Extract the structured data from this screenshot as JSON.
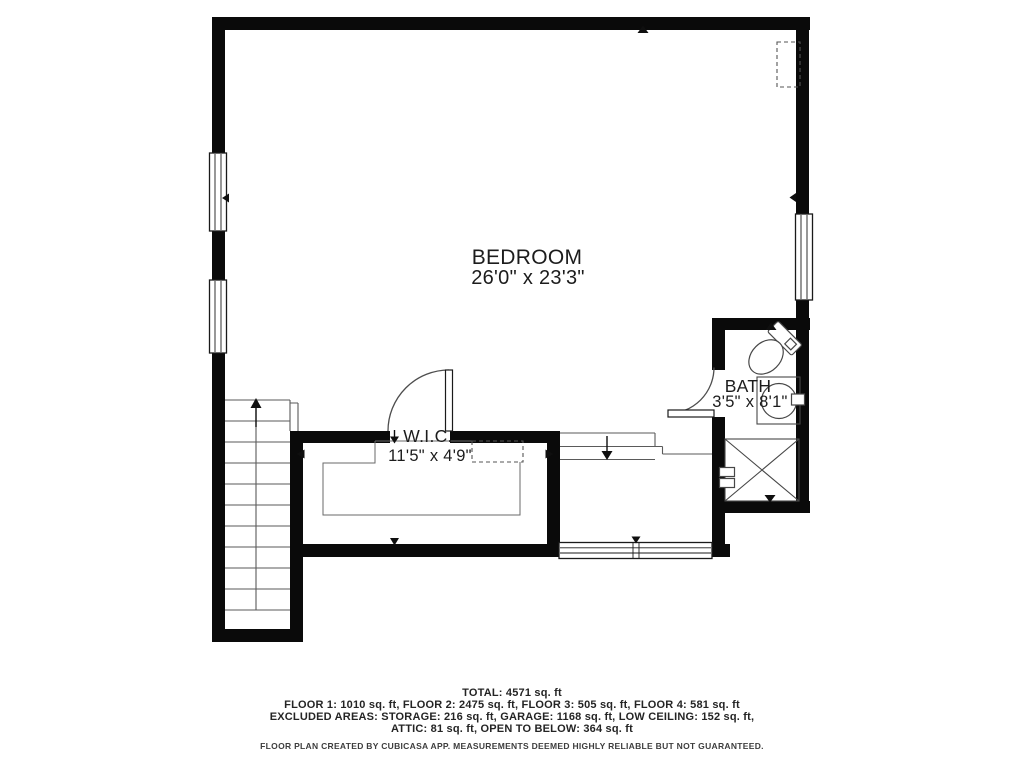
{
  "title": "Floor plan - Floor 4",
  "rooms": [
    {
      "name": "BEDROOM",
      "dimensions": "26'0\" x 23'3\""
    },
    {
      "name": "W.I.C.",
      "dimensions": "11'5\" x 4'9\""
    },
    {
      "name": "BATH",
      "dimensions": "3'5\" x 8'1\""
    }
  ],
  "fixtures": [
    "toilet",
    "sink",
    "shower",
    "staircase",
    "landing-steps",
    "closet"
  ],
  "footer": {
    "total": "TOTAL: 4571 sq. ft",
    "floors": "FLOOR 1: 1010 sq. ft, FLOOR 2: 2475 sq. ft, FLOOR 3: 505 sq. ft, FLOOR 4: 581 sq. ft",
    "excluded_line1": "EXCLUDED AREAS: STORAGE: 216 sq. ft, GARAGE: 1168 sq. ft, LOW CEILING: 152 sq. ft,",
    "excluded_line2": "ATTIC: 81 sq. ft, OPEN TO BELOW: 364 sq. ft",
    "disclaimer": "FLOOR PLAN CREATED BY CUBICASA APP. MEASUREMENTS DEEMED HIGHLY RELIABLE BUT NOT GUARANTEED."
  },
  "colors": {
    "wall": "#0a0a0a",
    "background": "#ffffff",
    "thin_line": "#5a5a5a",
    "fixture_line": "#474747",
    "text": "#1c1c1c"
  }
}
